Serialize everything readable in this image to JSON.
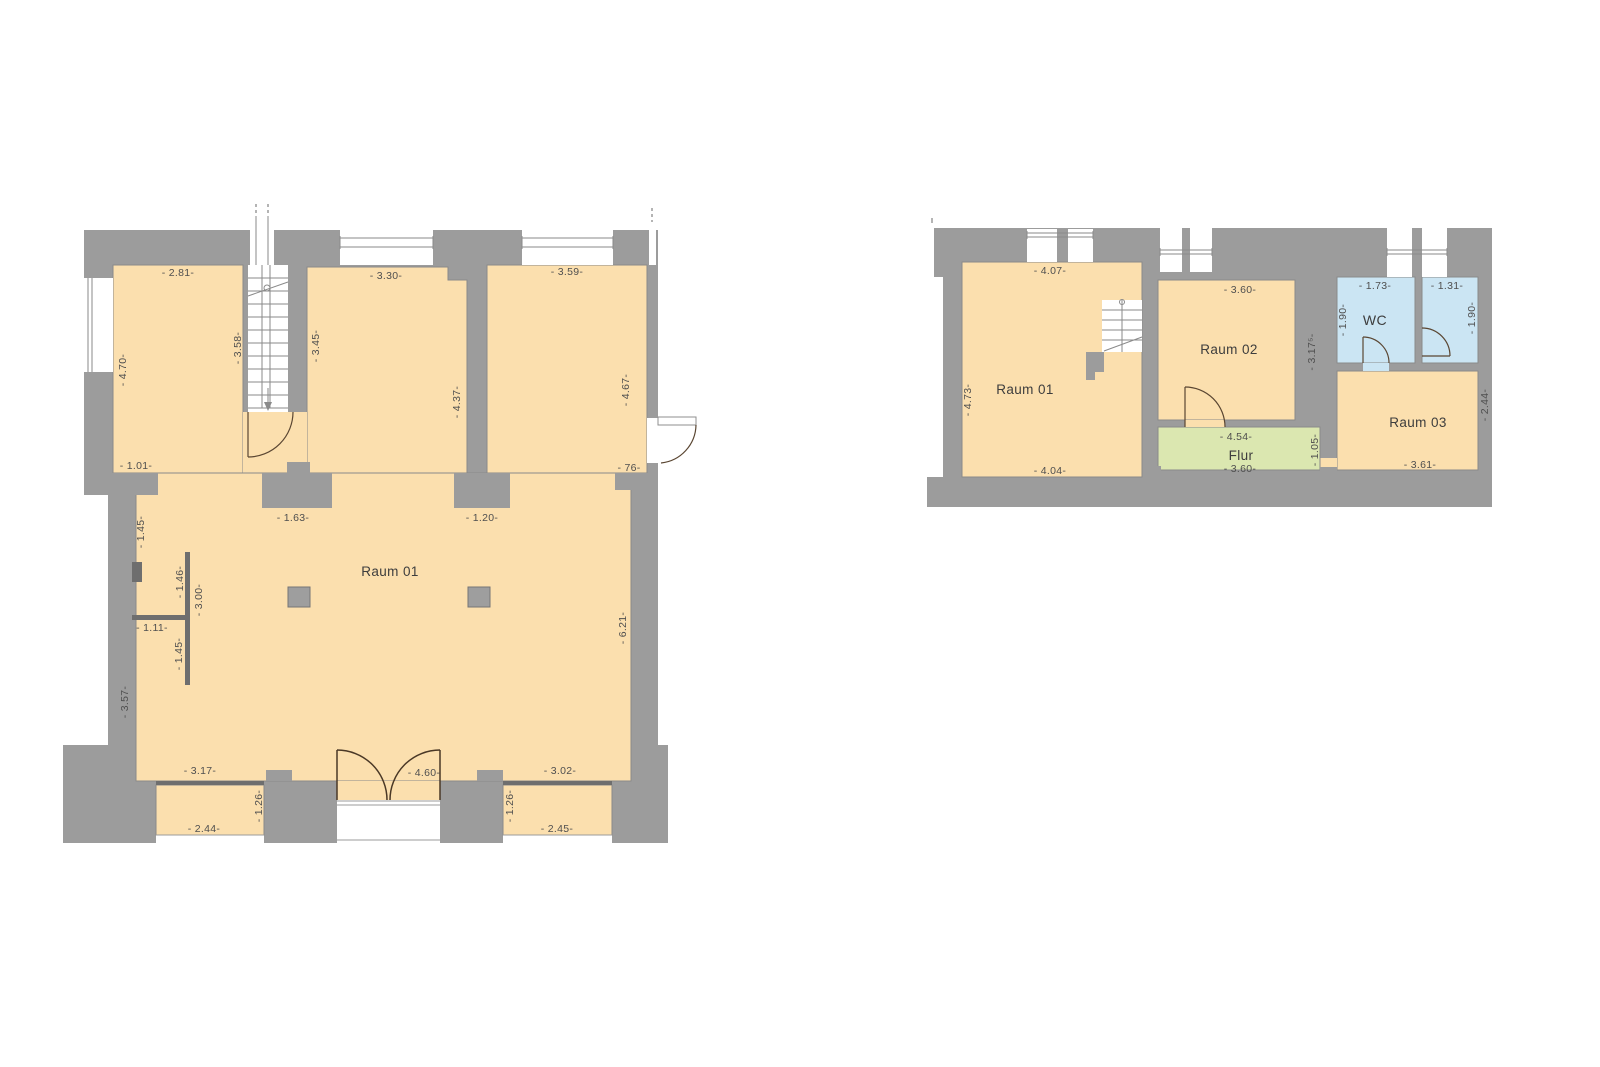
{
  "colors": {
    "wall": "#9c9c9c",
    "floor_orange": "#fbdfae",
    "wc_blue": "#cbe5f3",
    "corridor_green": "#dbe7b0"
  },
  "left_plan": {
    "room_label": "Raum 01",
    "dims": {
      "top_1": "- 2.81-",
      "top_2": "- 3.30-",
      "top_3": "- 3.59-",
      "left_v": "- 4.70-",
      "stair_v": "- 3.58-",
      "mid_left_v": "- 3.45-",
      "mid_right_v": "- 4.37-",
      "right_v": "- 4.67-",
      "niche": "- 1.01-",
      "pier_left": "- 1.63-",
      "pier_right": "- 1.20-",
      "door_right": "- 76-",
      "seg_145a": "- 1.45-",
      "seg_146": "- 1.46-",
      "seg_300": "- 3.00-",
      "seg_111": "- 1.11-",
      "seg_145b": "- 1.45-",
      "seg_357": "- 3.57-",
      "right_lower_v": "- 6.21-",
      "bottom_left": "- 3.17-",
      "entrance": "- 4.60-",
      "bottom_right": "- 3.02-",
      "alcove_left_w": "- 2.44-",
      "alcove_left_d": "- 1.26-",
      "alcove_right_w": "- 2.45-",
      "alcove_right_d": "- 1.26-"
    }
  },
  "right_plan": {
    "rooms": {
      "raum01": "Raum 01",
      "raum02": "Raum 02",
      "raum03": "Raum 03",
      "flur": "Flur",
      "wc": "WC"
    },
    "dims": {
      "r1_top": "- 4.07-",
      "r1_left_v": "- 4.73-",
      "r1_bottom": "- 4.04-",
      "r2_top": "- 3.60-",
      "r2_right_v": "- 3.17⁵-",
      "wc_top": "- 1.73-",
      "wc_left_v": "- 1.90-",
      "wc2_top": "- 1.31-",
      "wc2_right_v": "- 1.90-",
      "flur_top": "- 4.54-",
      "flur_bottom": "- 3.60-",
      "flur_right_v": "- 1.05-",
      "r3_right_v": "- 2.44-",
      "r3_bottom": "- 3.61-"
    }
  }
}
